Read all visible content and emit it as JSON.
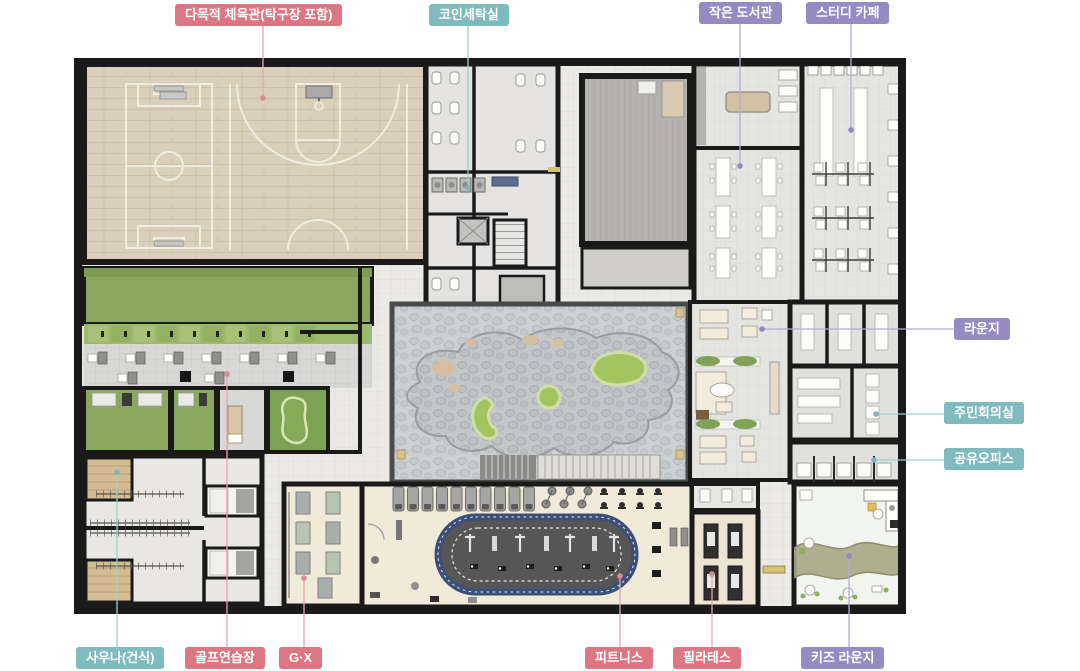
{
  "palette": {
    "label_sports_pink": "#db7682",
    "label_convenience_teal": "#7fbabe",
    "label_community_purple": "#958ac1",
    "label_text": "#ffffff",
    "leader_pink": "#e8a5ad",
    "leader_teal": "#9fced1",
    "leader_purple": "#b4aad3",
    "wall_black": "#1a1a1a",
    "gym_wood": "#d9cfba",
    "golf_green": "#8ba95e",
    "lawn_green": "#a2c560",
    "courtyard_stone": "#ccd0d3",
    "track_border_navy": "#3c4f78",
    "track_infield_gray": "#565656",
    "fitness_floor_cream": "#f0ead9",
    "sauna_wood_tan": "#d4bd92",
    "kids_wave_olive": "#a6a785"
  },
  "labels": {
    "gym": {
      "text": "다목적 체육관(탁구장 포함)",
      "category": "sports"
    },
    "laundry": {
      "text": "코인세탁실",
      "category": "convenience"
    },
    "library": {
      "text": "작은 도서관",
      "category": "community"
    },
    "study_cafe": {
      "text": "스터디 카페",
      "category": "community"
    },
    "lounge": {
      "text": "라운지",
      "category": "community"
    },
    "meeting_room": {
      "text": "주민회의실",
      "category": "convenience"
    },
    "shared_office": {
      "text": "공유오피스",
      "category": "convenience"
    },
    "sauna": {
      "text": "사우나(건식)",
      "category": "convenience"
    },
    "golf": {
      "text": "골프연습장",
      "category": "sports"
    },
    "gx": {
      "text": "G·X",
      "category": "sports"
    },
    "fitness": {
      "text": "피트니스",
      "category": "sports"
    },
    "pilates": {
      "text": "필라테스",
      "category": "sports"
    },
    "kids_lounge": {
      "text": "키즈 라운지",
      "category": "community"
    }
  }
}
